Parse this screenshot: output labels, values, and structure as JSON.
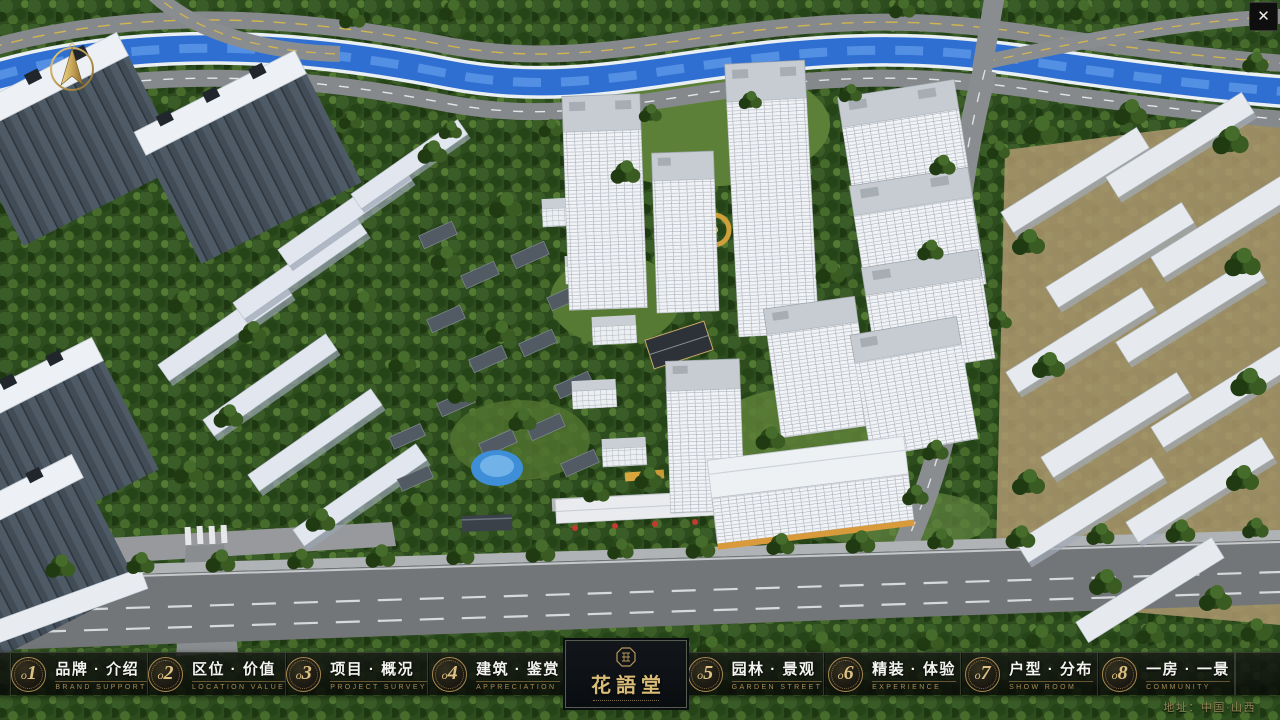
{
  "window": {
    "close_icon": "✕"
  },
  "logo": {
    "title": "花語堂"
  },
  "navbar": {
    "items": [
      {
        "num_prefix": "o",
        "num": "1",
        "label": "品牌 · 介绍",
        "sublabel": "BRAND SUPPORT"
      },
      {
        "num_prefix": "o",
        "num": "2",
        "label": "区位 · 价值",
        "sublabel": "LOCATION VALUE"
      },
      {
        "num_prefix": "o",
        "num": "3",
        "label": "项目 · 概况",
        "sublabel": "PROJECT SURVEY"
      },
      {
        "num_prefix": "o",
        "num": "4",
        "label": "建筑 · 鉴赏",
        "sublabel": "APPRECIATION"
      },
      {
        "num_prefix": "o",
        "num": "5",
        "label": "园林 · 景观",
        "sublabel": "GARDEN STREET"
      },
      {
        "num_prefix": "o",
        "num": "6",
        "label": "精装 · 体验",
        "sublabel": "EXPERIENCE"
      },
      {
        "num_prefix": "o",
        "num": "7",
        "label": "户型 · 分布",
        "sublabel": "SHOW ROOM"
      },
      {
        "num_prefix": "o",
        "num": "8",
        "label": "一房 · 一景",
        "sublabel": "COMMUNITY"
      }
    ]
  },
  "footer": {
    "address": "地址：中国·山西"
  },
  "colors": {
    "gold_accent": "#c9a96a",
    "panel_dark": "#0d100c",
    "river_blue": "#2f6fd2",
    "forest_green": "#31501f",
    "road_grey": "#85898c",
    "building_white": "#eef1f4"
  }
}
